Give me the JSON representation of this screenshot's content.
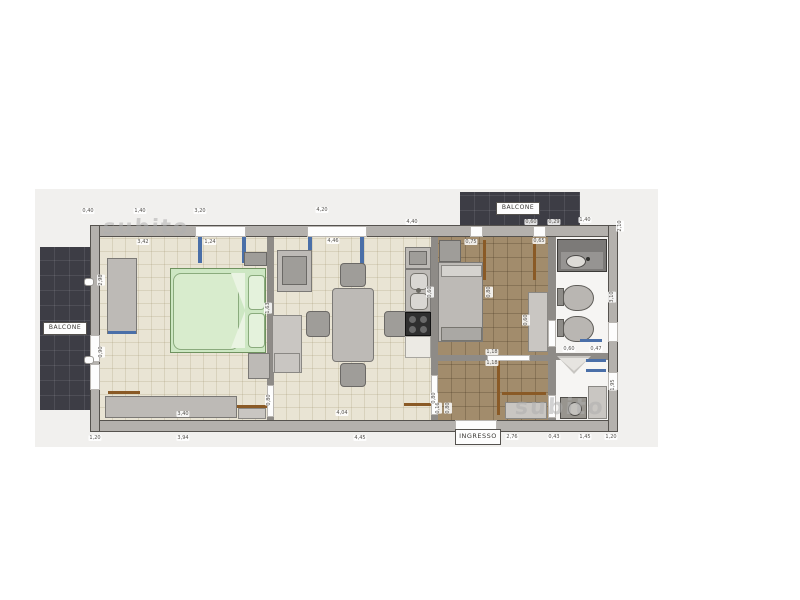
{
  "labels": {
    "balcony_left": "BALCONE",
    "balcony_top": "BALCONE",
    "entrance": "INGRESSO"
  },
  "watermarks": {
    "top_left": "subito",
    "bottom_right": "subito"
  },
  "colors": {
    "paper": "#f1f0ee",
    "outer_wall": "#b4b1ad",
    "beige_floor": "#e9e4d4",
    "brown_floor": "#a28c6c",
    "balcony": "#3d3d45",
    "bed_green": "#cde7c3",
    "window_blue": "#4a6fa8",
    "door_brown": "#8a5a26"
  },
  "dimensions": [
    {
      "x": 88,
      "y": 211,
      "t": "0,40"
    },
    {
      "x": 140,
      "y": 211,
      "t": "1,40"
    },
    {
      "x": 200,
      "y": 211,
      "t": "3,20"
    },
    {
      "x": 322,
      "y": 210,
      "t": "4,20"
    },
    {
      "x": 412,
      "y": 222,
      "t": "4,40"
    },
    {
      "x": 531,
      "y": 222,
      "t": "0,60"
    },
    {
      "x": 554,
      "y": 222,
      "t": "0,29"
    },
    {
      "x": 585,
      "y": 220,
      "t": "1,40"
    },
    {
      "x": 143,
      "y": 242,
      "t": "3,42"
    },
    {
      "x": 210,
      "y": 242,
      "t": "1,24"
    },
    {
      "x": 333,
      "y": 241,
      "t": "4,46"
    },
    {
      "x": 471,
      "y": 242,
      "t": "0,75"
    },
    {
      "x": 539,
      "y": 241,
      "t": "0,65"
    },
    {
      "x": 620,
      "y": 226,
      "t": "2,10",
      "v": true
    },
    {
      "x": 612,
      "y": 297,
      "t": "3,10",
      "v": true
    },
    {
      "x": 613,
      "y": 385,
      "t": "1,95",
      "v": true
    },
    {
      "x": 95,
      "y": 438,
      "t": "1,20"
    },
    {
      "x": 183,
      "y": 438,
      "t": "3,94"
    },
    {
      "x": 360,
      "y": 438,
      "t": "4,45"
    },
    {
      "x": 512,
      "y": 437,
      "t": "2,76"
    },
    {
      "x": 554,
      "y": 437,
      "t": "0,43"
    },
    {
      "x": 585,
      "y": 437,
      "t": "1,45"
    },
    {
      "x": 611,
      "y": 437,
      "t": "1,20"
    },
    {
      "x": 183,
      "y": 414,
      "t": "3,40"
    },
    {
      "x": 342,
      "y": 413,
      "t": "4,04"
    },
    {
      "x": 101,
      "y": 280,
      "t": "2,98",
      "v": true
    },
    {
      "x": 101,
      "y": 352,
      "t": "0,90",
      "v": true
    },
    {
      "x": 492,
      "y": 352,
      "t": "1,18"
    },
    {
      "x": 492,
      "y": 363,
      "t": "1,18"
    },
    {
      "x": 569,
      "y": 349,
      "t": "0,60"
    },
    {
      "x": 596,
      "y": 349,
      "t": "0,47"
    },
    {
      "x": 430,
      "y": 292,
      "t": "0,60",
      "v": true
    },
    {
      "x": 526,
      "y": 320,
      "t": "0,60",
      "v": true
    },
    {
      "x": 489,
      "y": 292,
      "t": "0,80",
      "v": true
    },
    {
      "x": 268,
      "y": 308,
      "t": "1,63",
      "v": true
    },
    {
      "x": 269,
      "y": 400,
      "t": "0,80",
      "v": true
    },
    {
      "x": 434,
      "y": 398,
      "t": "0,80",
      "v": true
    },
    {
      "x": 438,
      "y": 408,
      "t": "0,16",
      "v": true
    },
    {
      "x": 448,
      "y": 408,
      "t": "0,80",
      "v": true
    }
  ]
}
